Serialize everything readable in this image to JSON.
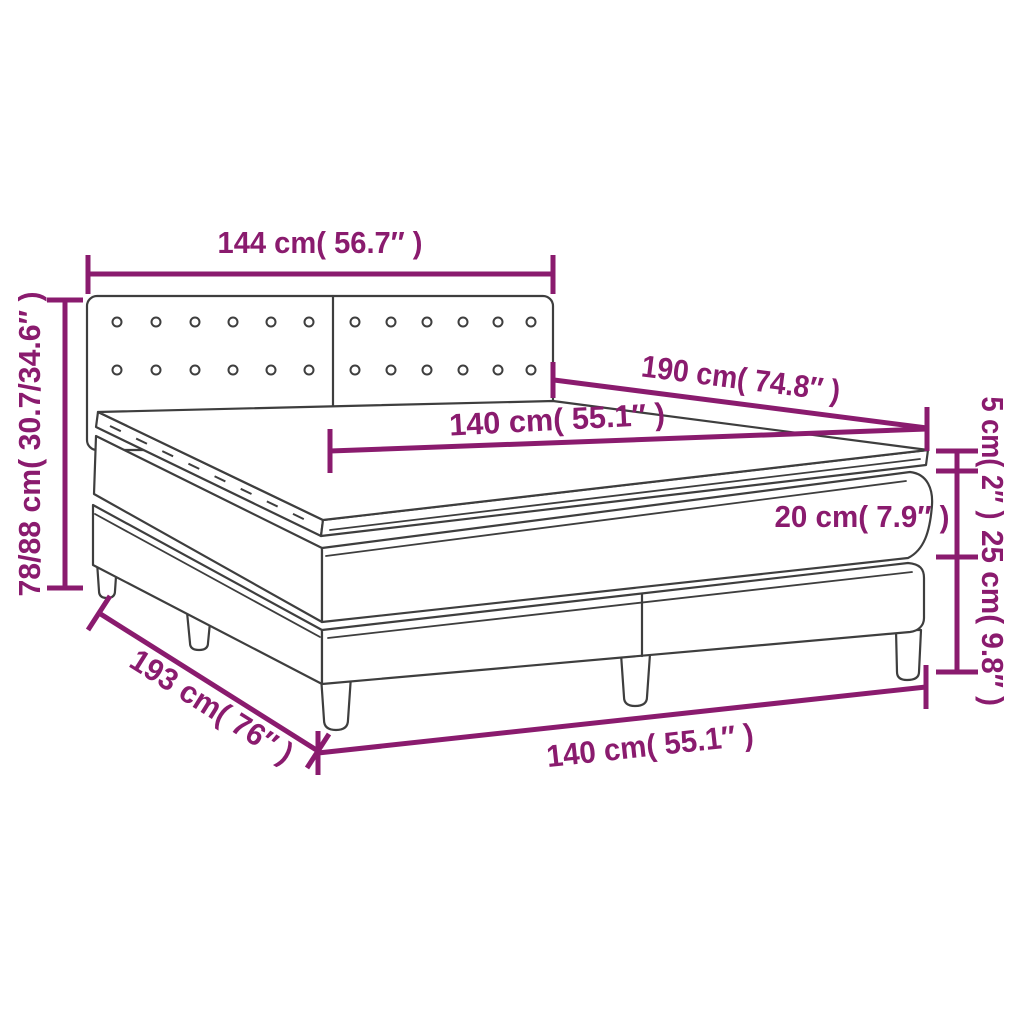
{
  "diagram": {
    "subject": "Box spring bed with mattress and topper dimension diagram",
    "colors": {
      "dimension_color": "#8a1b6e",
      "outline_color": "#3e3e3e",
      "background": "#ffffff"
    },
    "labels": {
      "headboard_width": "144 cm( 56.7″ )",
      "overall_height": "78/88 cm( 30.7/34.6″ )",
      "bed_length": "190 cm( 74.8″ )",
      "mattress_width": "140 cm( 55.1″ )",
      "topper_thickness": "5 cm( 2″ )",
      "mattress_thickness": "20 cm( 7.9″ )",
      "base_height": "25 cm( 9.8″ )",
      "overall_length": "193 cm( 76″ )",
      "overall_width": "140 cm( 55.1″ )"
    },
    "headboard": {
      "panels": 2,
      "button_rows": 2,
      "buttons_per_row": 12
    }
  }
}
